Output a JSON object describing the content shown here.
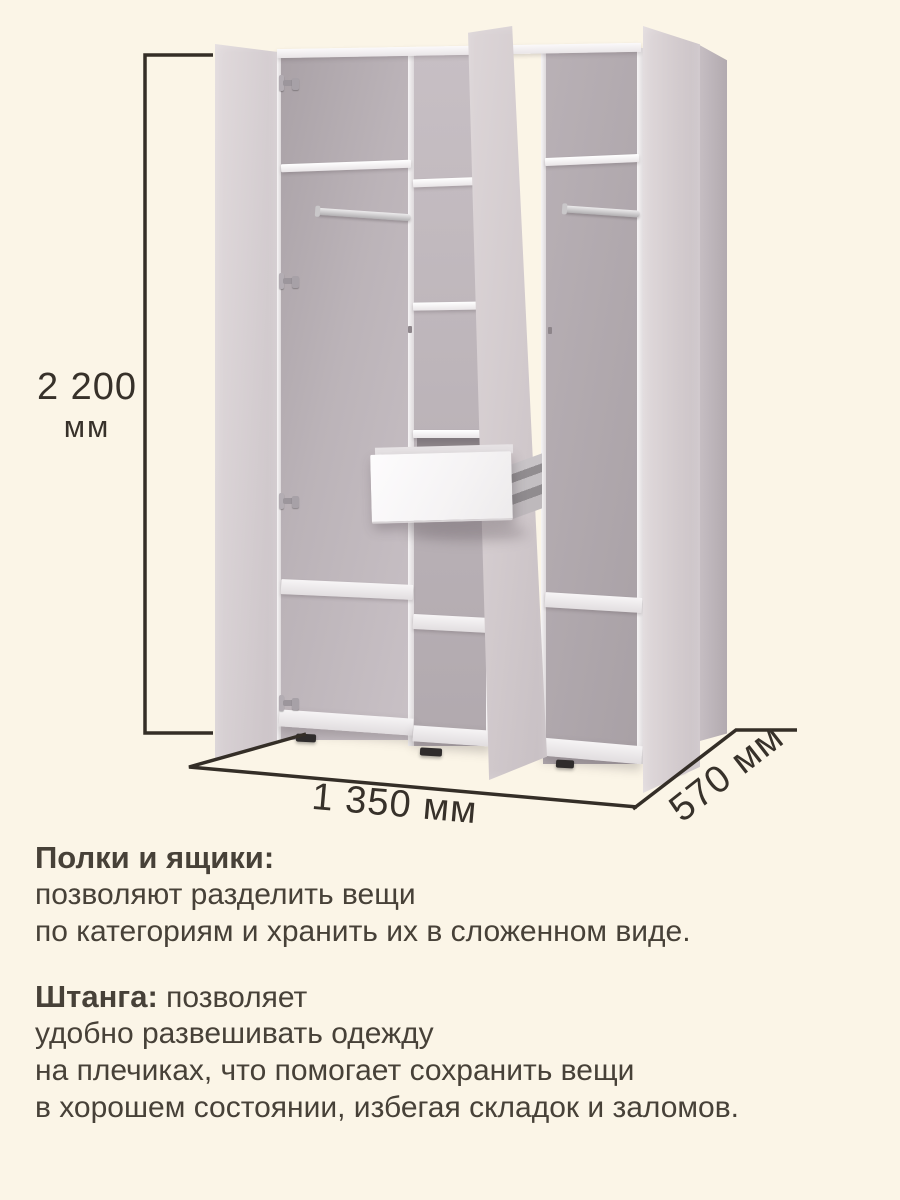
{
  "dimensions": {
    "height": {
      "value": "2 200",
      "unit": "мм"
    },
    "width": {
      "label": "1 350 мм"
    },
    "depth": {
      "label": "570 мм"
    }
  },
  "features": {
    "block1": {
      "heading": "Полки и ящики:",
      "line1": "позволяют разделить вещи",
      "line2": "по категориям и хранить их в сложенном виде."
    },
    "block2": {
      "heading": "Штанга:",
      "heading_rest": " позволяет",
      "line1": "удобно развешивать одежду",
      "line2": "на плечиках, что помогает сохранить вещи",
      "line3": "в хорошем состоянии, избегая складок и заломов."
    }
  },
  "colors": {
    "background": "#fbf5e7",
    "dimension_line": "#342e27",
    "dimension_text": "#37312a",
    "body_text": "#474138",
    "cabinet_face": "#d5cdd0",
    "cabinet_interior": "#b2aaaf",
    "shelf_white": "#f4f2f3"
  }
}
